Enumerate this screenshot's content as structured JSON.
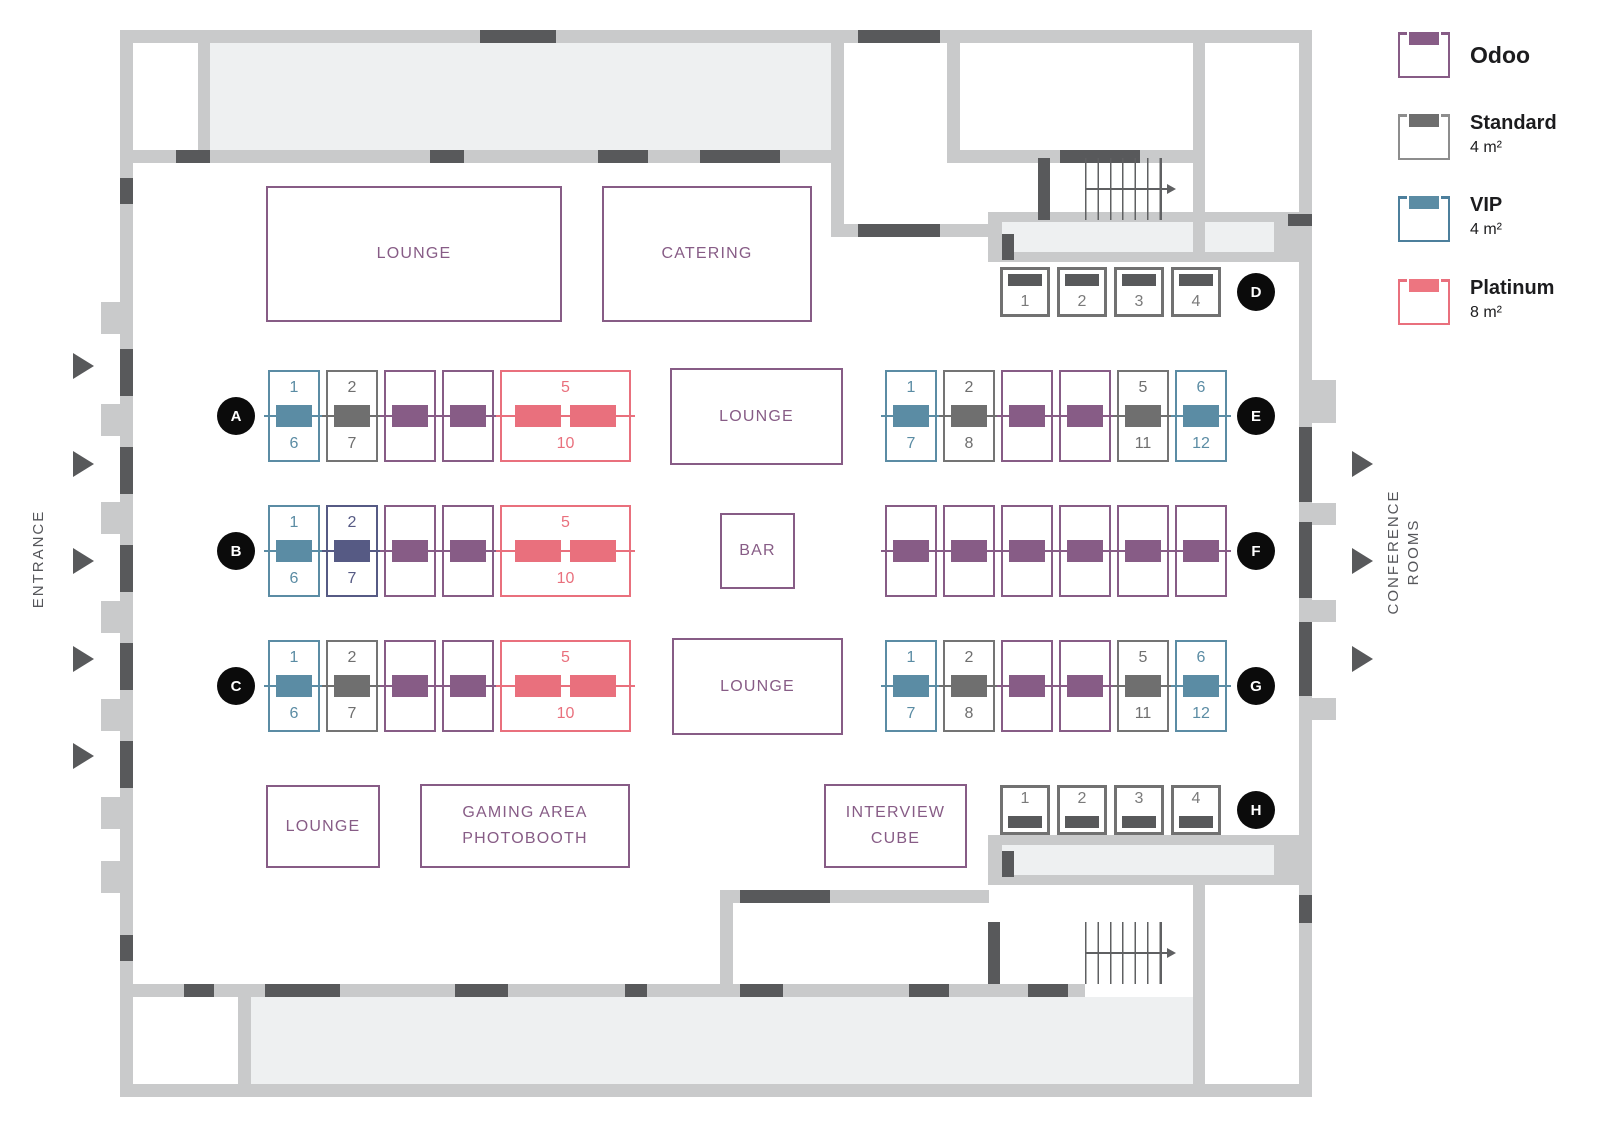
{
  "legend": {
    "items": [
      {
        "name": "Odoo",
        "size": ""
      },
      {
        "name": "Standard",
        "size": "4 m²"
      },
      {
        "name": "VIP",
        "size": "4 m²"
      },
      {
        "name": "Platinum",
        "size": "8 m²"
      }
    ]
  },
  "labels": {
    "entrance": "ENTRANCE",
    "conference": "CONFERENCE",
    "rooms": "ROOMS"
  },
  "areas": {
    "lounge_top": "LOUNGE",
    "catering": "CATERING",
    "lounge_mid_top": "LOUNGE",
    "bar": "BAR",
    "lounge_mid_bottom": "LOUNGE",
    "lounge_bottom": "LOUNGE",
    "gaming_line1": "GAMING AREA",
    "gaming_line2": "PHOTOBOOTH",
    "interview_line1": "INTERVIEW",
    "interview_line2": "CUBE"
  },
  "rows": {
    "A": {
      "letter": "A",
      "booths": [
        {
          "top": "1",
          "bottom": "6"
        },
        {
          "top": "2",
          "bottom": "7"
        },
        {},
        {},
        {
          "top": "5",
          "bottom": "10"
        }
      ]
    },
    "B": {
      "letter": "B",
      "booths": [
        {
          "top": "1",
          "bottom": "6"
        },
        {
          "top": "2",
          "bottom": "7"
        },
        {},
        {},
        {
          "top": "5",
          "bottom": "10"
        }
      ]
    },
    "C": {
      "letter": "C",
      "booths": [
        {
          "top": "1",
          "bottom": "6"
        },
        {
          "top": "2",
          "bottom": "7"
        },
        {},
        {},
        {
          "top": "5",
          "bottom": "10"
        }
      ]
    },
    "D": {
      "letter": "D",
      "booths": [
        {
          "num": "1"
        },
        {
          "num": "2"
        },
        {
          "num": "3"
        },
        {
          "num": "4"
        }
      ]
    },
    "E": {
      "letter": "E",
      "booths": [
        {
          "top": "1",
          "bottom": "7"
        },
        {
          "top": "2",
          "bottom": "8"
        },
        {},
        {},
        {
          "top": "5",
          "bottom": "11"
        },
        {
          "top": "6",
          "bottom": "12"
        }
      ]
    },
    "F": {
      "letter": "F",
      "booths": [
        {},
        {},
        {},
        {},
        {},
        {}
      ]
    },
    "G": {
      "letter": "G",
      "booths": [
        {
          "top": "1",
          "bottom": "7"
        },
        {
          "top": "2",
          "bottom": "8"
        },
        {},
        {},
        {
          "top": "5",
          "bottom": "11"
        },
        {
          "top": "6",
          "bottom": "12"
        }
      ]
    },
    "H": {
      "letter": "H",
      "booths": [
        {
          "num": "1"
        },
        {
          "num": "2"
        },
        {
          "num": "3"
        },
        {
          "num": "4"
        }
      ]
    }
  },
  "colors": {
    "odoo": "#875c86",
    "standard": "#6f6f6f",
    "vip": "#5b8ca4",
    "platinum": "#e9707d",
    "reserved": "#565a84",
    "wall": "#c9cacb",
    "door": "#58595b",
    "room_fill": "#eef0f1",
    "marker": "#0b0b0b"
  }
}
